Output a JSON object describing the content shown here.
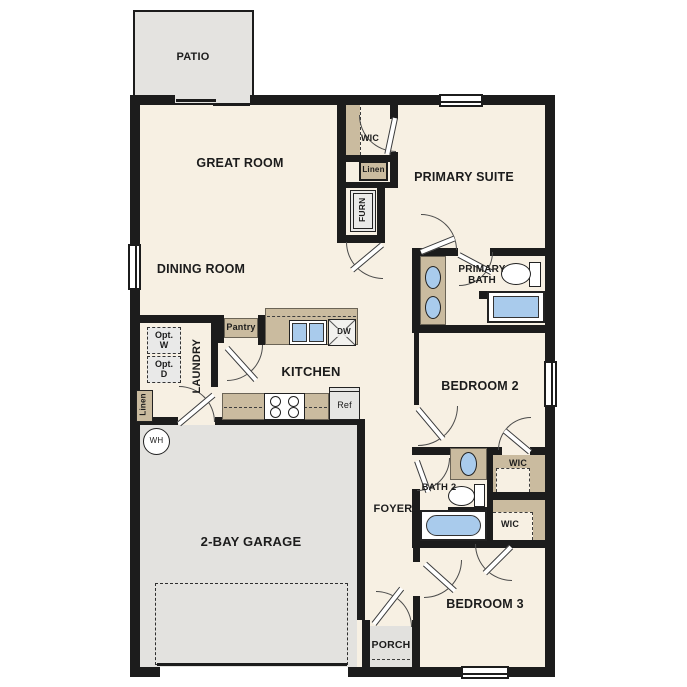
{
  "colors": {
    "wall": "#1c1c1c",
    "floor": "#f7f0e3",
    "garage": "#e3e2df",
    "patio": "#e4e3e0",
    "porch": "#e2e1de",
    "tan": "#cabb9f",
    "blue": "#a9cbec",
    "boxgray": "#e9e9e8",
    "line": "#4a4a4a"
  },
  "labels": {
    "patio": "PATIO",
    "great_room": "GREAT ROOM",
    "dining_room": "DINING ROOM",
    "primary_suite": "PRIMARY SUITE",
    "primary_bath": "PRIMARY BATH",
    "wic_primary": "WIC",
    "linen_hall": "Linen",
    "furnace": "FURN",
    "laundry": "LAUNDRY",
    "opt_washer": "Opt. W",
    "opt_dryer": "Opt. D",
    "linen_laundry": "Linen",
    "pantry": "Pantry",
    "kitchen": "KITCHEN",
    "dishwasher": "DW",
    "refrigerator": "Ref",
    "water_heater": "WH",
    "garage": "2-BAY GARAGE",
    "foyer": "FOYER",
    "bath_2": "BATH 2",
    "wic_bedroom2": "WIC",
    "wic_bedroom3": "WIC",
    "bedroom_2": "BEDROOM 2",
    "bedroom_3": "BEDROOM 3",
    "porch": "PORCH"
  }
}
